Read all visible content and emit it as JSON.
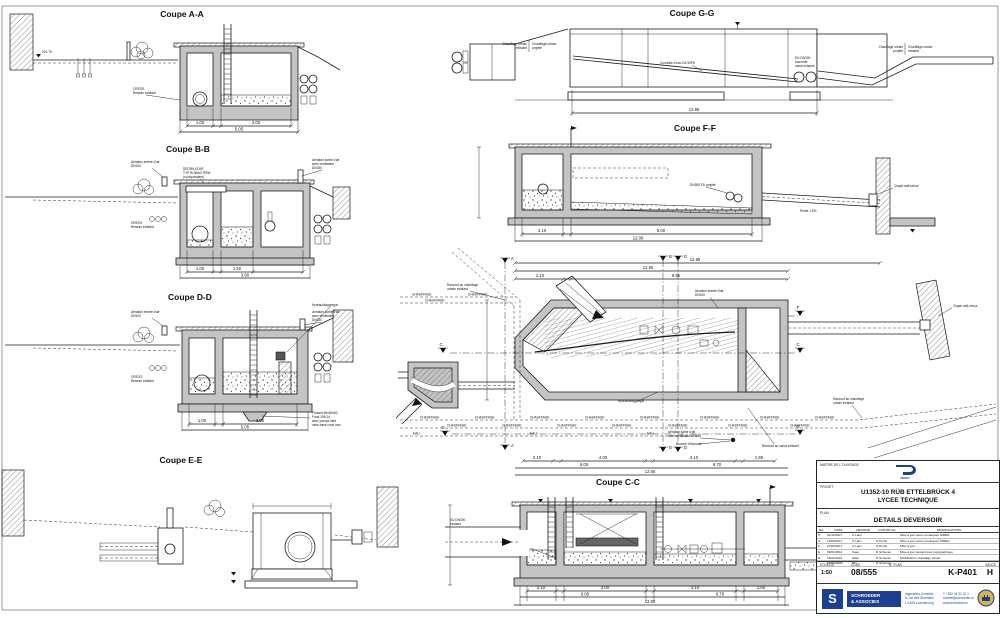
{
  "aa": {
    "title": "Coupe A-A",
    "creos1": "CREOS",
    "creos2": "Réseau existant",
    "elev": "201.75",
    "d1": "1.00",
    "d2": "3.00",
    "tot": "5.05"
  },
  "bb": {
    "title": "Coupe B-B",
    "in1": "Aération entrée d'air",
    "in2": "DN100",
    "deg1": "DEGRILLEUR",
    "deg2": "TYP ROMAG RSW",
    "deg3": "(ou équivalent)",
    "out1": "Aération sortie d'air",
    "out2": "avec ventilateur",
    "out3": "DN150",
    "creos1": "CREOS",
    "creos2": "Réseau existant",
    "d1": "1.00",
    "d2": "1.50",
    "tot": "3.60"
  },
  "dd": {
    "title": "Coupe D-D",
    "in1": "Aération entrée d'air",
    "in2": "DN100",
    "hyd": "Hydraulikaggregat",
    "out1": "Aération sortie d'air",
    "out2": "avec ventilateur",
    "out3": "DN150",
    "creos1": "CREOS",
    "creos2": "Réseau existant",
    "pu1": "Puisard 60x60x60",
    "pu2": "Fond 196.24",
    "pu3": "avec pompe vide",
    "pu4": "cave dans cuve inox",
    "d1": "1.00",
    "d2": "3.00",
    "tot": "5.05"
  },
  "ee": {
    "title": "Coupe E-E"
  },
  "gg": {
    "title": "Coupe G-G",
    "chx1": "Chauffage urbain",
    "chx2": "existant",
    "chp1": "Chauffage urbain",
    "chp2": "projeté",
    "cond": "Conduite d'eau DA 90PE",
    "eu1": "EU DN300",
    "eu2": "raccordé",
    "eu3": "canal existant",
    "tot": "12.86"
  },
  "ff": {
    "title": "Coupe F-F",
    "dn": "DN350 FD projeté",
    "clapet": "Clapet anti-retour",
    "pente": "Pente 1.5%",
    "d1": "2.10",
    "d2": "9.00",
    "tot": "12.00"
  },
  "cc": {
    "title": "Coupe C-C",
    "eu1": "EU DN300",
    "eu2": "existant",
    "d1": "2.10",
    "d2": "4.00",
    "d3": "3.10",
    "d4": "1.60",
    "s1": "6.05",
    "s2": "6.70",
    "tot": "12.50"
  },
  "plan": {
    "r1a": "Raccord au chauffage",
    "r1b": "urbain existant",
    "rc": "Raccord au canal existant",
    "clapet": "Clapet anti-retour",
    "in1": "Aération entrée d'air",
    "in2": "DN100",
    "out1": "Aération sortie d'air",
    "out2": "avec ventilateur DN150",
    "bouche": "Bouche d'incendie",
    "hyd": "Hydraulikaggregat",
    "ch": "CHAUFFAGE",
    "eau": "EAU",
    "mA": "A",
    "mB": "B",
    "mD": "D",
    "mC": "C",
    "mF": "F",
    "mG": "G",
    "t1": "12.86",
    "t2": "12.50",
    "d1": "2.10",
    "d2": "9.55",
    "b1": "2.10",
    "b2": "4.00",
    "b3": "3.10",
    "b4": "1.90",
    "s1": "6.05",
    "s2": "6.70",
    "btot": "12.50"
  },
  "tb": {
    "maitre": "MAÎTRE DE L'OUVRAGE",
    "logo": "SIDEN",
    "projet_label": "PROJET",
    "projet1": "U1352-10 RÜB ETTELBRÜCK 4",
    "projet2": "LYCEE TECHNIQUE",
    "plan_label": "PLAN",
    "plan_title": "DETAILS DEVERSOIR",
    "h_no": "NO.",
    "h_date": "DATE",
    "h_des": "DESSINE",
    "h_ctl": "CONTROLE",
    "h_mod": "MODIFICATIONS",
    "rev": [
      {
        "no": "H",
        "date": "01/12/2017",
        "des": "C.Lanz",
        "ctl": "",
        "mod": "Mise à jour selon remarques SIDEN"
      },
      {
        "no": "G",
        "date": "12/09/2017",
        "des": "C.Lanz",
        "ctl": "D.Pertel",
        "mod": "Mise à jour selon remarques SIDEN"
      },
      {
        "no": "F",
        "date": "27/06/2017",
        "des": "C.Lanz",
        "ctl": "D.Pertel",
        "mod": "Mise à jour"
      },
      {
        "no": "E",
        "date": "06/01/2011",
        "des": "Sase",
        "ctl": "D.Schosse",
        "mod": "Mise à jour suivant levé topographique"
      },
      {
        "no": "D",
        "date": "19/11/2010",
        "des": "Sase",
        "ctl": "D.Schosse",
        "mod": "Modification chauffage urbain"
      },
      {
        "no": "-",
        "date": "09/06/2009",
        "des": "Bin",
        "ctl": "D.Schosse",
        "mod": ""
      }
    ],
    "echelle_l": "ECHELLE",
    "code_l": "CODE",
    "nplan_l": "N° PLAN",
    "indice_l": "INDICE",
    "echelle": "1:50",
    "code": "08/555",
    "nplan": "K-P401",
    "indice": "H",
    "firm1": "SCHROEDER",
    "firm2": "& ASSOCIES",
    "a1": "Ingénieurs-Conseils",
    "a2": "8, rue des Girondins",
    "a3": "L-1626 Luxembourg",
    "c1": "T +352 44 31 31 1",
    "c2": "conseil@schroeder.lu",
    "c3": "www.schroeder.lu"
  }
}
